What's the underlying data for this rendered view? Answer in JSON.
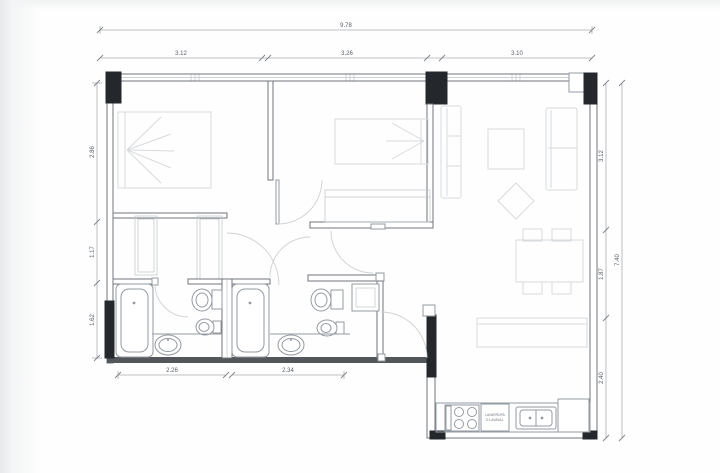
{
  "plan": {
    "kind": "apartment-floor-plan",
    "dimensions": {
      "top": {
        "total": "9.78",
        "segments": [
          "3.12",
          "3.26",
          "3.10"
        ]
      },
      "left": {
        "segments": [
          "2.86",
          "1.17",
          "1.62"
        ]
      },
      "right": {
        "total": "7.40",
        "segments": [
          "3.12",
          "1.87",
          "2.40"
        ]
      },
      "bottom": {
        "segments": [
          "2.26",
          "2.34"
        ]
      }
    },
    "labels": {
      "appliance": {
        "line1": "LAVARROPA",
        "line2": "O LAVAVAJ."
      }
    },
    "colors": {
      "wall_outline": "#70767c",
      "wall_dark": "#53575c",
      "column": "#24282c",
      "furniture": "#d7dbde",
      "fixture": "#949ba2",
      "dimension_line": "#a8adb2",
      "dimension_text": "#595f66",
      "background": "#fcfcfd"
    }
  }
}
